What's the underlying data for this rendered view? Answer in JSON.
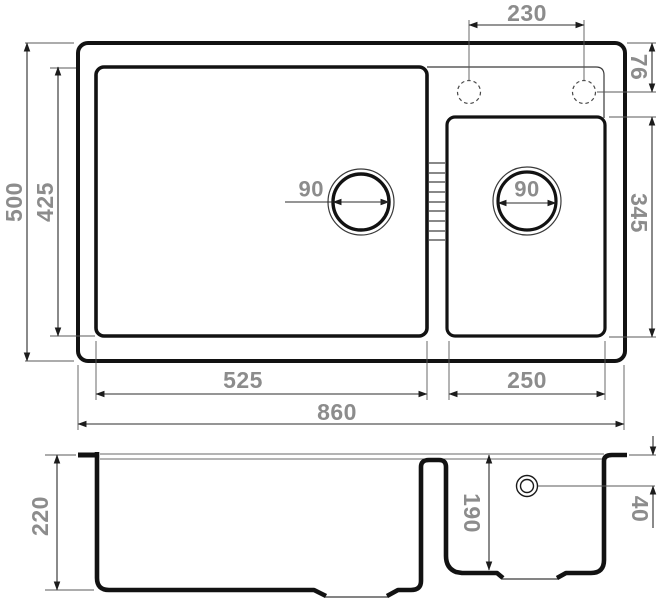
{
  "labels": {
    "faucet_spacing": "230",
    "deck_offset": "76",
    "overall_depth": "500",
    "main_bowl_depth": "425",
    "main_drain_diameter": "90",
    "small_drain_diameter": "90",
    "small_bowl_depth": "345",
    "main_bowl_width": "525",
    "small_bowl_width": "250",
    "overall_width": "860",
    "main_bowl_height": "220",
    "small_bowl_height": "190",
    "overflow_offset": "40"
  },
  "colors": {
    "line": "#121212",
    "dimension_text": "#8c8c8c",
    "background": "#ffffff"
  }
}
